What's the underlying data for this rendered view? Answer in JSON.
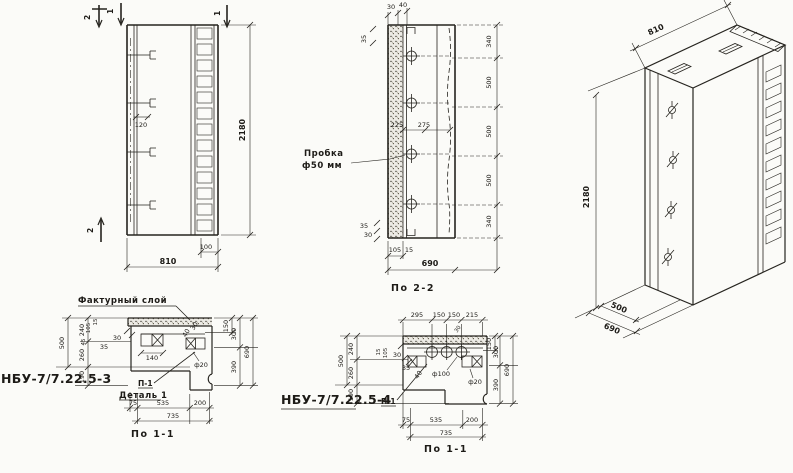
{
  "paper": {
    "background": "#fbfbf8",
    "ink": "#26241f"
  },
  "views": {
    "elevation": {
      "section_marks": {
        "top_2": "2",
        "top_1": "1",
        "right_1": "1",
        "bottom_2": "2"
      },
      "dims": {
        "height": "2180",
        "width": "810",
        "strip": "100",
        "rib": "120"
      }
    },
    "section_2_2": {
      "caption": "По 2-2",
      "plug_label": [
        "Пробка",
        "ф50 мм"
      ],
      "right_chain": [
        "340",
        "500",
        "500",
        "500",
        "340"
      ],
      "dims": {
        "a225": "225",
        "b275": "275",
        "t30": "30",
        "t40": "40",
        "l35": "35",
        "bl35": "35",
        "bl30": "30",
        "b105": "105",
        "b15": "15",
        "width": "690"
      }
    },
    "isometric": {
      "dims": {
        "width": "810",
        "height": "2180",
        "d500": "500",
        "d690": "690"
      }
    },
    "detail_1_left": {
      "code": "НБУ-7/7.22.5-3",
      "caption": "По 1-1",
      "surface_label": "Фактурный слой",
      "detail_label": "Деталь 1",
      "marker": "П-1",
      "left_chain": {
        "total": "500",
        "a": "240",
        "b": "260",
        "c": "190"
      },
      "right_chain": {
        "small": "150",
        "a": "300",
        "b": "390",
        "total": "690"
      },
      "bottom_chain": {
        "a": "75",
        "b": "535",
        "c": "200",
        "total": "735"
      },
      "inner_dims": {
        "d30": "30",
        "d15": "15",
        "d105": "105",
        "d45": "45",
        "d35": "35",
        "d140": "140",
        "d40": "40",
        "d30b": "30",
        "hole": "ф20"
      }
    },
    "detail_1_middle": {
      "code": "НБУ-7/7.22.5-4",
      "caption": "По 1-1",
      "marker": "П-1",
      "top_chain": {
        "a": "295",
        "b": "150",
        "c": "150",
        "d": "215",
        "diag30": "30"
      },
      "left_chain": {
        "total": "500",
        "a": "240",
        "b": "260",
        "c": "190"
      },
      "right_chain": {
        "small": "150",
        "a": "300",
        "b": "390",
        "total": "690"
      },
      "bottom_chain": {
        "a": "75",
        "b": "535",
        "c": "200",
        "total": "735"
      },
      "inner_dims": {
        "d15": "15",
        "d105": "105",
        "d30": "30",
        "d35": "35",
        "d40": "40",
        "hole_big": "ф100",
        "hole": "ф20"
      }
    }
  }
}
